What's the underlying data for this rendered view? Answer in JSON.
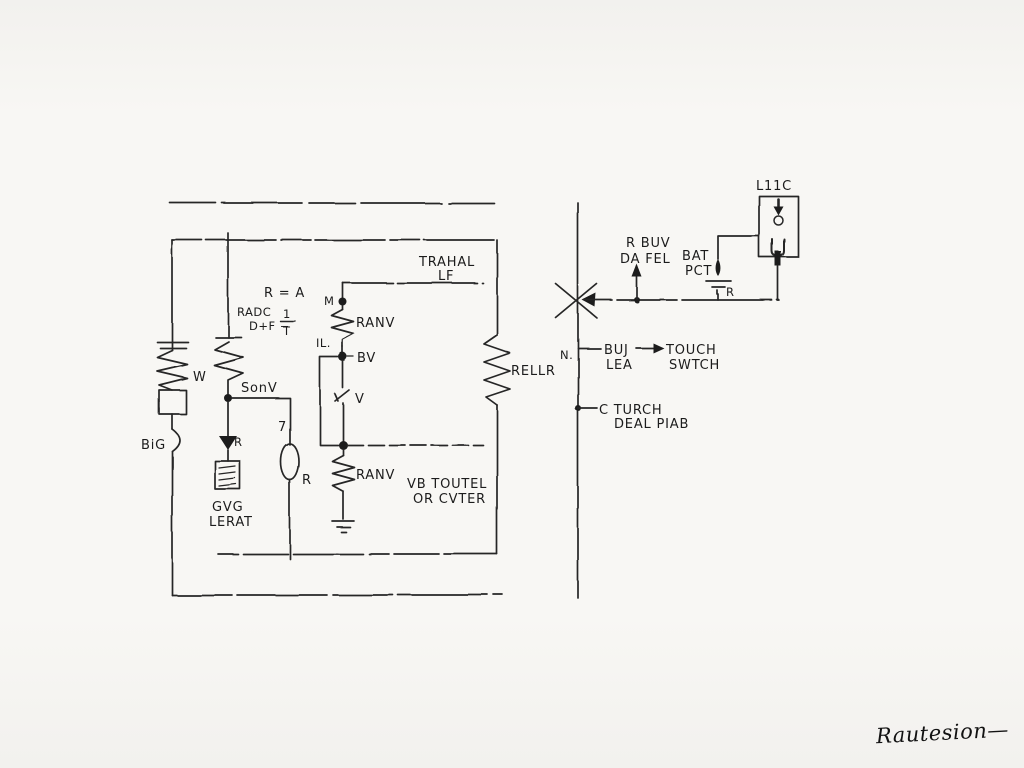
{
  "doc": {
    "type": "hand-drawn circuit schematic",
    "paper_color": "#f6f5f2",
    "ink_color": "#262626"
  },
  "main_circuit": {
    "transformer_note": {
      "line1": "TRAHAL",
      "line2": "LF"
    },
    "formula": {
      "line1": "R = A",
      "line2a": "RADC",
      "line2b": "D+F −",
      "fraction_numerator": "1",
      "fraction_denominator": "T"
    },
    "branch_left": {
      "resistor_label": "W",
      "lead_label": "BiG"
    },
    "branch_sensor": {
      "resistor_label": "SonV",
      "diode_label": "R",
      "meter_line1": "GVG",
      "meter_line2": "LERAT"
    },
    "branch_source": {
      "value_label": "7",
      "source_label": "R"
    },
    "branch_divider": {
      "node_top_label": "M",
      "resistor_top_label": "RANV",
      "node_side_label": "IL.",
      "tap_label": "BV",
      "varistor_label": "V",
      "resistor_bottom_label": "RANV"
    },
    "branch_relay": {
      "resistor_label": "RELLR"
    },
    "output_note": {
      "line1": "VB TOUTEL",
      "line2": "OR CVTER"
    }
  },
  "right_circuit": {
    "bus_label": "N.",
    "supply_note": {
      "line1": "R BUV",
      "line2": "DA FEL"
    },
    "battery_note": {
      "line1": "BAT",
      "line2": "PCT",
      "resistor_label": "R"
    },
    "lamp_label": "L11C",
    "tap_touch": {
      "from_line1": "BUJ",
      "from_line2": "LEA",
      "to_line1": "TOUCH",
      "to_line2": "SWTCH"
    },
    "tap_pedal": {
      "line1": "C TURCH",
      "line2": "DEAL PIAB"
    }
  },
  "signature": "Rautesion—"
}
